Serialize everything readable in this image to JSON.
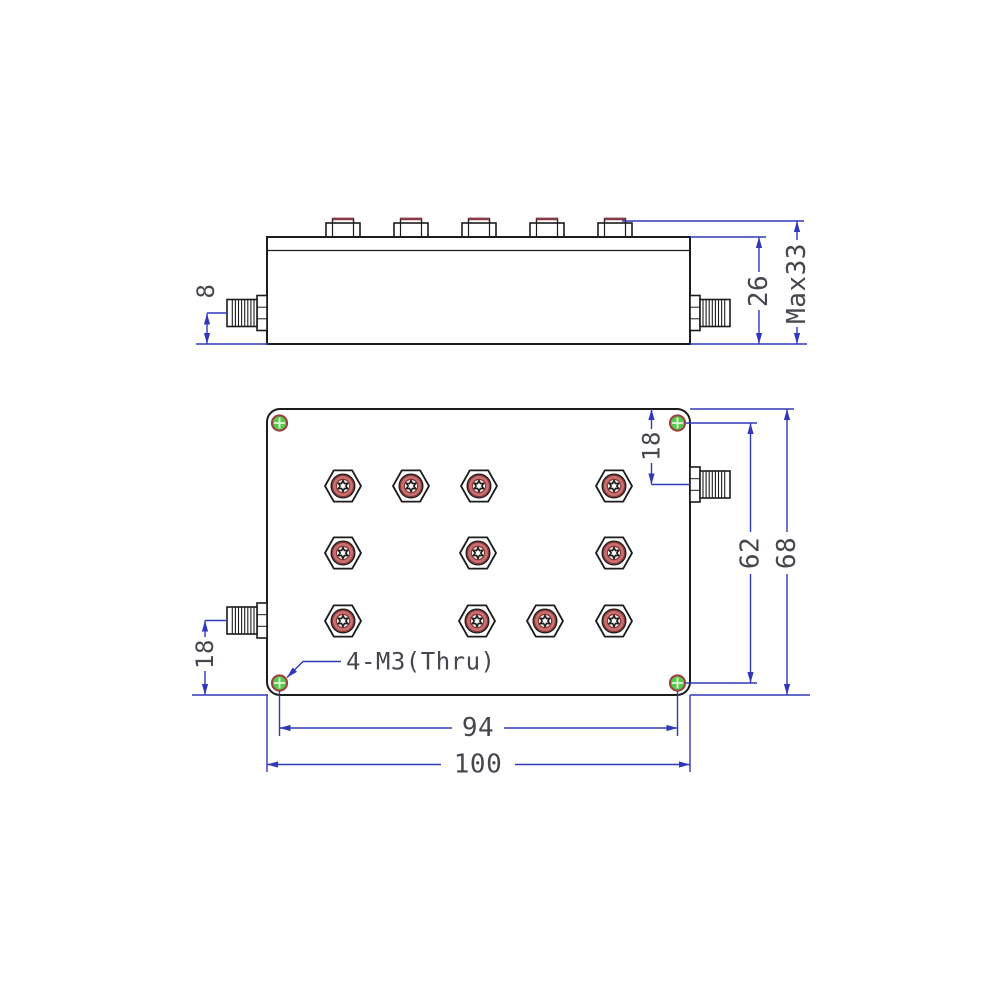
{
  "drawing_type": "mechanical-outline-drawing-two-views-rf-cavity-filter",
  "colors": {
    "dim": "#3038bb",
    "ink": "#1c1c1c",
    "text": "#46464e",
    "ring": "#c86f6f",
    "ring-edge": "#8b3535",
    "nut-cap": "#8c3a46",
    "hole-green": "#56c94e",
    "hole-ring": "#9b4040",
    "hole-cross": "#e4f8dc"
  },
  "dims": {
    "d8": "8",
    "d26": "26",
    "dmax": "Max33",
    "d18_right": "18",
    "d62": "62",
    "d68": "68",
    "d18_left": "18",
    "d94": "94",
    "d100": "100"
  },
  "labels": {
    "mounting_holes": "4-M3(Thru)"
  },
  "counts": {
    "tuning_screws": 11,
    "top_lock_nuts": 5,
    "mounting_holes": 4,
    "sma_connectors_per_view": 2
  },
  "stamps": {
    "top-nuts": {
      "symbol": "#sym-nut",
      "name": "hex-lock-nut-side",
      "points": [
        [
          343,
          237
        ],
        [
          411,
          237
        ],
        [
          479,
          237
        ],
        [
          547,
          237
        ],
        [
          615,
          237
        ]
      ]
    },
    "tuning-screws": {
      "symbol": "#sym-screw",
      "name": "tuning-screw",
      "points": [
        [
          343,
          486
        ],
        [
          411,
          486
        ],
        [
          479,
          486
        ],
        [
          614,
          486
        ],
        [
          343,
          553
        ],
        [
          478,
          553
        ],
        [
          614,
          553
        ],
        [
          343,
          621
        ],
        [
          477,
          621
        ],
        [
          545,
          621
        ],
        [
          614,
          621
        ]
      ]
    },
    "corner-holes": {
      "symbol": "#sym-hole",
      "name": "mounting-hole",
      "points": [
        [
          279.5,
          423
        ],
        [
          677.5,
          423
        ],
        [
          279.5,
          683
        ],
        [
          677.5,
          683
        ]
      ]
    }
  }
}
